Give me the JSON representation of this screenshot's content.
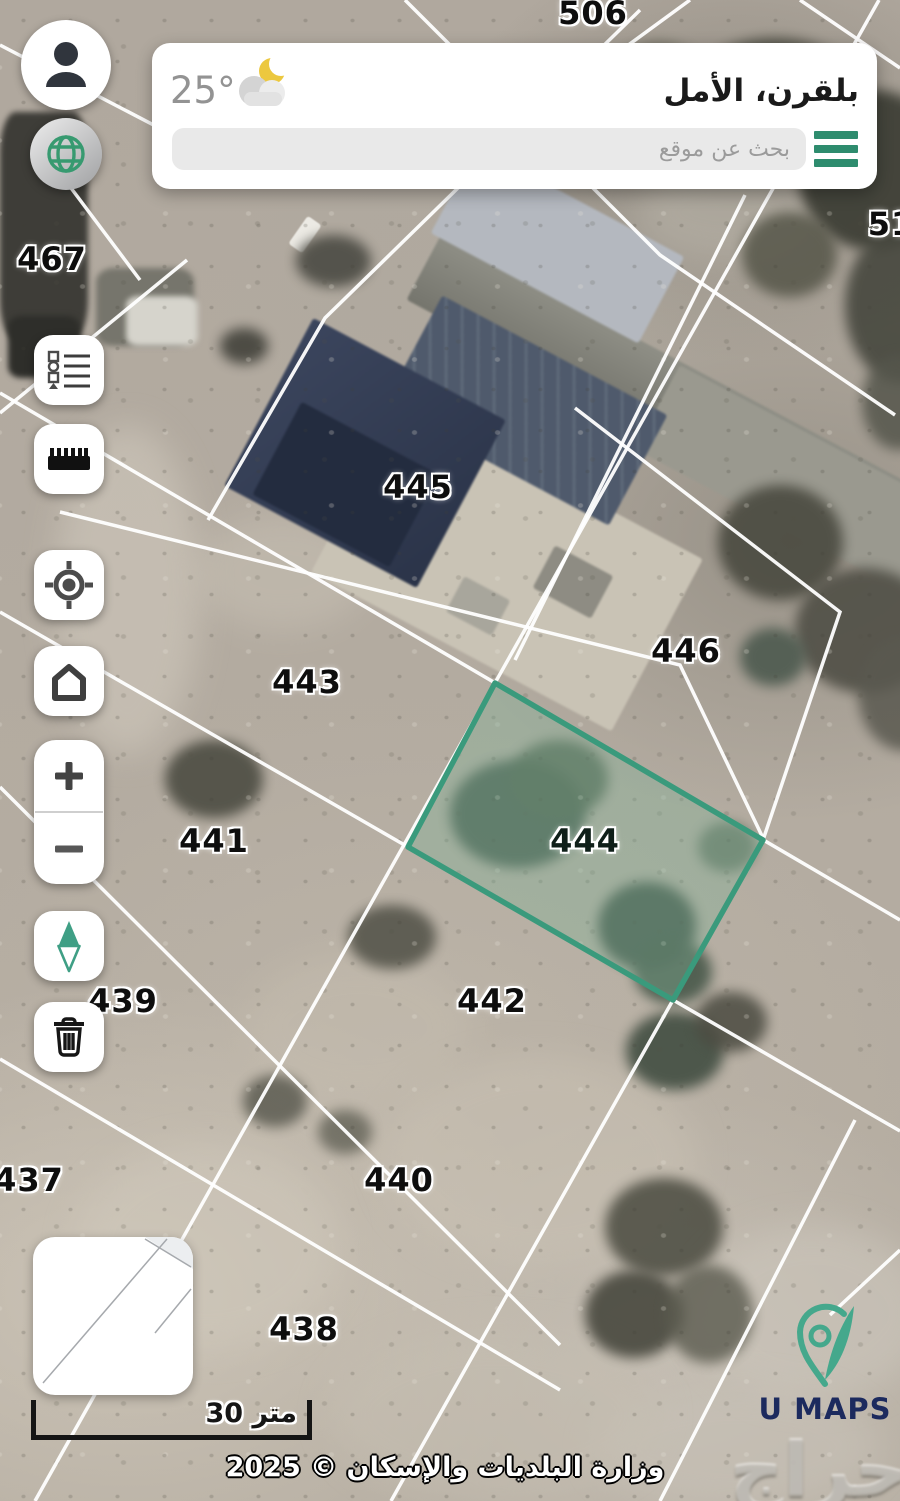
{
  "app": {
    "name": "U MAPS"
  },
  "colors": {
    "accent": "#2e8c6e",
    "parcel_stroke": "#3a9a7c",
    "parcel_fill": "rgba(125,176,151,0.38)",
    "logo_icon": "#45a88c",
    "logo_text": "#1c2a5e"
  },
  "header": {
    "temperature": "25°",
    "weather_icon": "moon-cloud-icon",
    "location_title": "بلقرن، الأمل",
    "search_placeholder": "بحث عن موقع",
    "menu_icon": "hamburger-icon"
  },
  "sidebar": {
    "buttons": [
      {
        "name": "profile-button",
        "icon": "user-icon"
      },
      {
        "name": "globe-button",
        "icon": "globe-icon"
      },
      {
        "name": "legend-button",
        "icon": "legend-list-icon"
      },
      {
        "name": "measure-button",
        "icon": "ruler-icon"
      },
      {
        "name": "locate-button",
        "icon": "crosshair-icon"
      },
      {
        "name": "home-button",
        "icon": "home-icon"
      },
      {
        "name": "zoom-in-button",
        "icon": "plus-icon"
      },
      {
        "name": "zoom-out-button",
        "icon": "minus-icon"
      },
      {
        "name": "compass-button",
        "icon": "compass-needle-icon"
      },
      {
        "name": "delete-button",
        "icon": "trash-icon"
      }
    ]
  },
  "map": {
    "parcel_labels": [
      {
        "id": "506",
        "x": 593,
        "y": 13
      },
      {
        "id": "51",
        "x": 891,
        "y": 224
      },
      {
        "id": "467",
        "x": 52,
        "y": 259
      },
      {
        "id": "445",
        "x": 418,
        "y": 487
      },
      {
        "id": "446",
        "x": 686,
        "y": 651
      },
      {
        "id": "443",
        "x": 307,
        "y": 682
      },
      {
        "id": "441",
        "x": 214,
        "y": 841
      },
      {
        "id": "444",
        "x": 585,
        "y": 841,
        "highlight": true
      },
      {
        "id": "442",
        "x": 492,
        "y": 1001
      },
      {
        "id": "439",
        "x": 123,
        "y": 1001
      },
      {
        "id": "437",
        "x": 29,
        "y": 1180
      },
      {
        "id": "440",
        "x": 399,
        "y": 1180
      },
      {
        "id": "438",
        "x": 304,
        "y": 1329
      }
    ],
    "highlighted_parcel": {
      "id": "444",
      "points": "495,683 763,840 673,1000 408,847"
    },
    "boundary_lines": [
      "879,0 35,1501",
      "575,408 840,612 763,840 673,1000 391,1501",
      "0,393 900,920",
      "0,612 408,847 900,1131",
      "405,0 660,255 895,415",
      "800,0 900,68",
      "690,0 560,95 430,170",
      "640,10 325,318 208,520",
      "745,195 515,660",
      "60,512 680,665 763,838",
      "0,787 560,1345",
      "0,1059 560,1390",
      "855,1120 660,1501",
      "830,1315 900,1250",
      "187,260 0,413",
      "0,45 240,170",
      "56,168 140,280"
    ],
    "minimap_lines": [
      "112,2 158,30",
      "134,2 10,146",
      "158,52 122,96"
    ],
    "scale_bar_label": "30 متر",
    "attribution": "وزارة البلديات والإسكان © 2025",
    "watermark": "حراج"
  },
  "logo": {
    "text": "U MAPS"
  }
}
